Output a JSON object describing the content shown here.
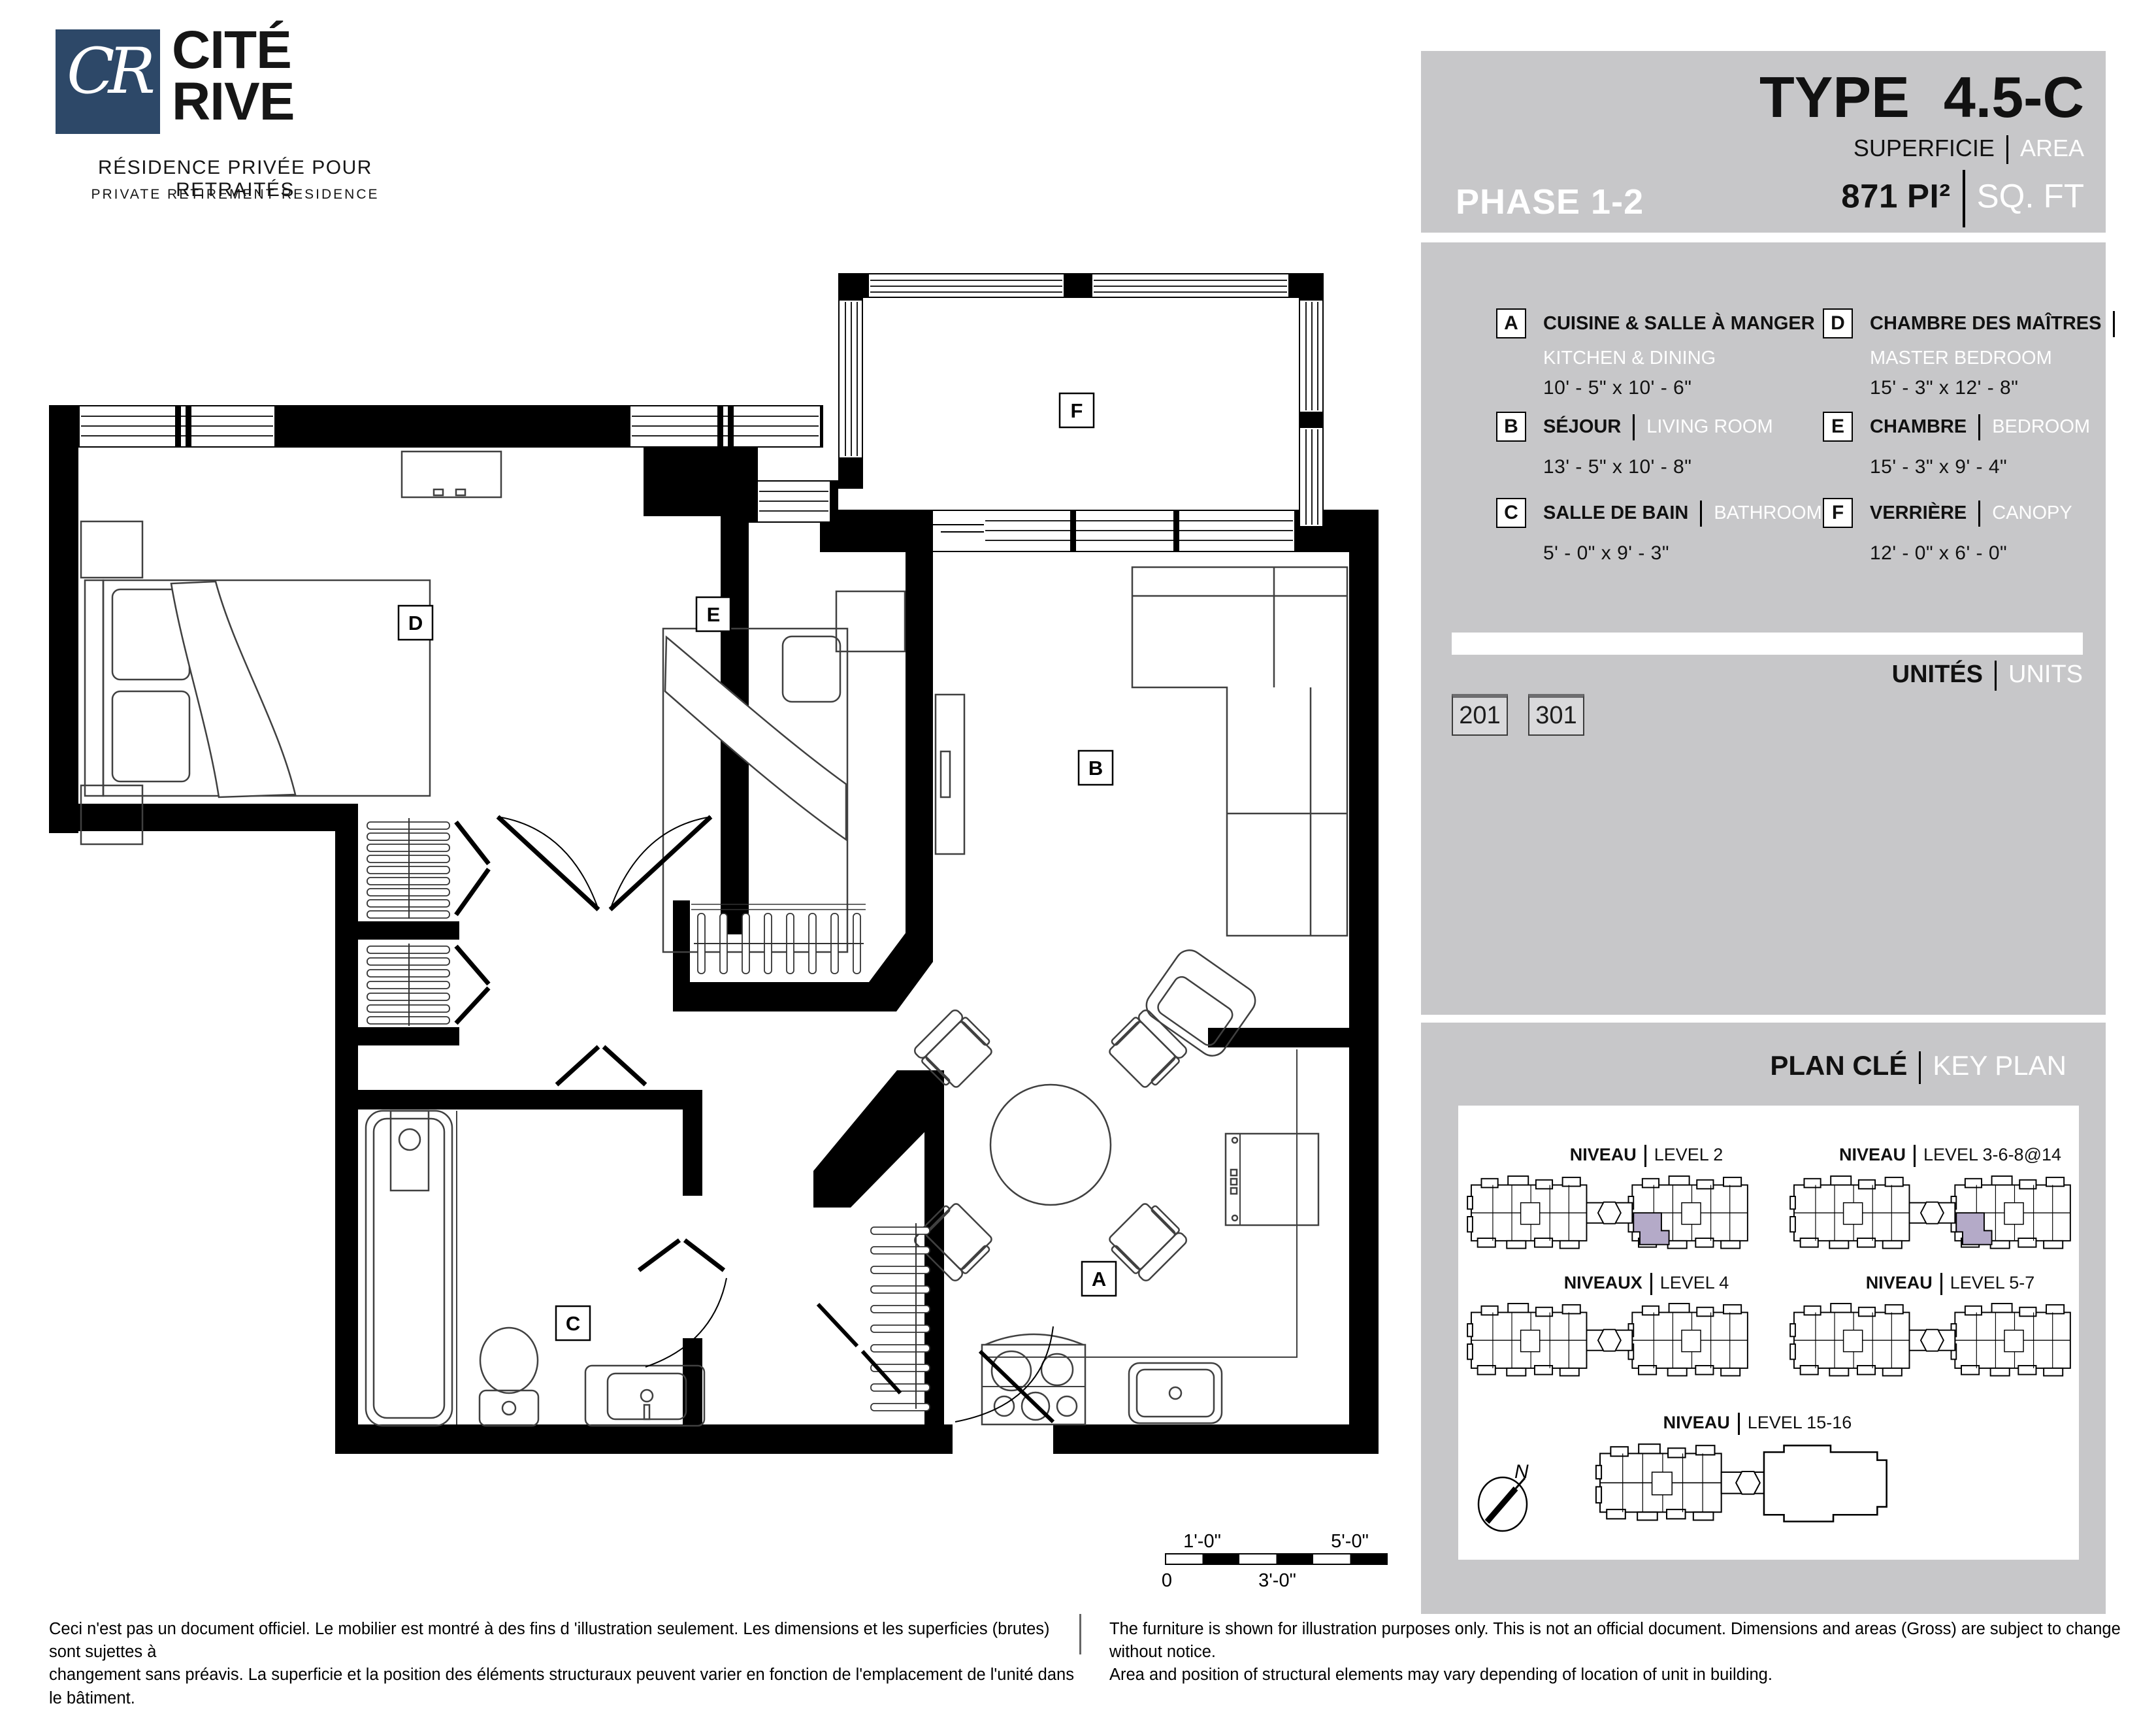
{
  "logo": {
    "monogram": "CR",
    "name1": "CITÉ",
    "name2": "RIVE",
    "tagline_fr": "RÉSIDENCE PRIVÉE POUR RETRAITÉS",
    "tagline_en": "PRIVATE RETIREMENT RESIDENCE"
  },
  "header": {
    "phase": "PHASE 1-2",
    "type_label": "TYPE",
    "type_value": "4.5-C",
    "area_label_fr": "SUPERFICIE",
    "area_label_en": "AREA",
    "area_value": "871",
    "area_unit_fr": "PI²",
    "area_unit_en": "SQ. FT"
  },
  "legend": [
    {
      "key": "A",
      "fr": "CUISINE & SALLE À MANGER",
      "en": "KITCHEN & DINING",
      "dims": "10' - 5\" x 10' - 6\""
    },
    {
      "key": "B",
      "fr": "SÉJOUR",
      "en": "LIVING ROOM",
      "dims": "13' - 5\" x 10' - 8\""
    },
    {
      "key": "C",
      "fr": "SALLE DE BAIN",
      "en": "BATHROOM",
      "dims": "5' - 0\" x 9' - 3\""
    },
    {
      "key": "D",
      "fr": "CHAMBRE DES MAÎTRES",
      "en": "MASTER BEDROOM",
      "dims": "15' - 3\" x 12' - 8\""
    },
    {
      "key": "E",
      "fr": "CHAMBRE",
      "en": "BEDROOM",
      "dims": "15' - 3\" x 9' - 4\""
    },
    {
      "key": "F",
      "fr": "VERRIÈRE",
      "en": "CANOPY",
      "dims": "12' - 0\" x 6' - 0\""
    }
  ],
  "units_section": {
    "label_fr": "UNITÉS",
    "label_en": "UNITS",
    "units": [
      "201",
      "301"
    ]
  },
  "key_plan": {
    "title_fr": "PLAN CLÉ",
    "title_en": "KEY PLAN",
    "levels": [
      {
        "fr": "NIVEAU",
        "en": "LEVEL 2"
      },
      {
        "fr": "NIVEAU",
        "en": "LEVEL 3-6-8@14"
      },
      {
        "fr": "NIVEAUX",
        "en": "LEVEL 4"
      },
      {
        "fr": "NIVEAU",
        "en": "LEVEL 5-7"
      },
      {
        "fr": "NIVEAU",
        "en": "LEVEL 15-16"
      }
    ],
    "compass": "N"
  },
  "floor_plan": {
    "room_labels": {
      "a": "A",
      "b": "B",
      "c": "C",
      "d": "D",
      "e": "E",
      "f": "F"
    },
    "scale": {
      "ft1": "1'-0\"",
      "ft5": "5'-0\"",
      "zero": "0",
      "ft3": "3'-0\""
    }
  },
  "disclaimers": {
    "fr": "Ceci n'est pas un document officiel.  Le mobilier est montré à des fins d 'illustration seulement.  Les dimensions et les superficies (brutes) sont sujettes à\nchangement sans préavis. La superficie et la position des éléments structuraux peuvent varier en fonction de l'emplacement de l'unité dans le bâtiment.",
    "en": "The furniture is shown for illustration purposes only.  This is not an official document.  Dimensions and areas (Gross) are subject to change without notice.\nArea and position of structural elements may vary depending of location of unit in building."
  },
  "colors": {
    "panel_gray": "#c7c7c9",
    "logo_blue": "#2d4868",
    "unit_highlight": "#b4aac8"
  }
}
